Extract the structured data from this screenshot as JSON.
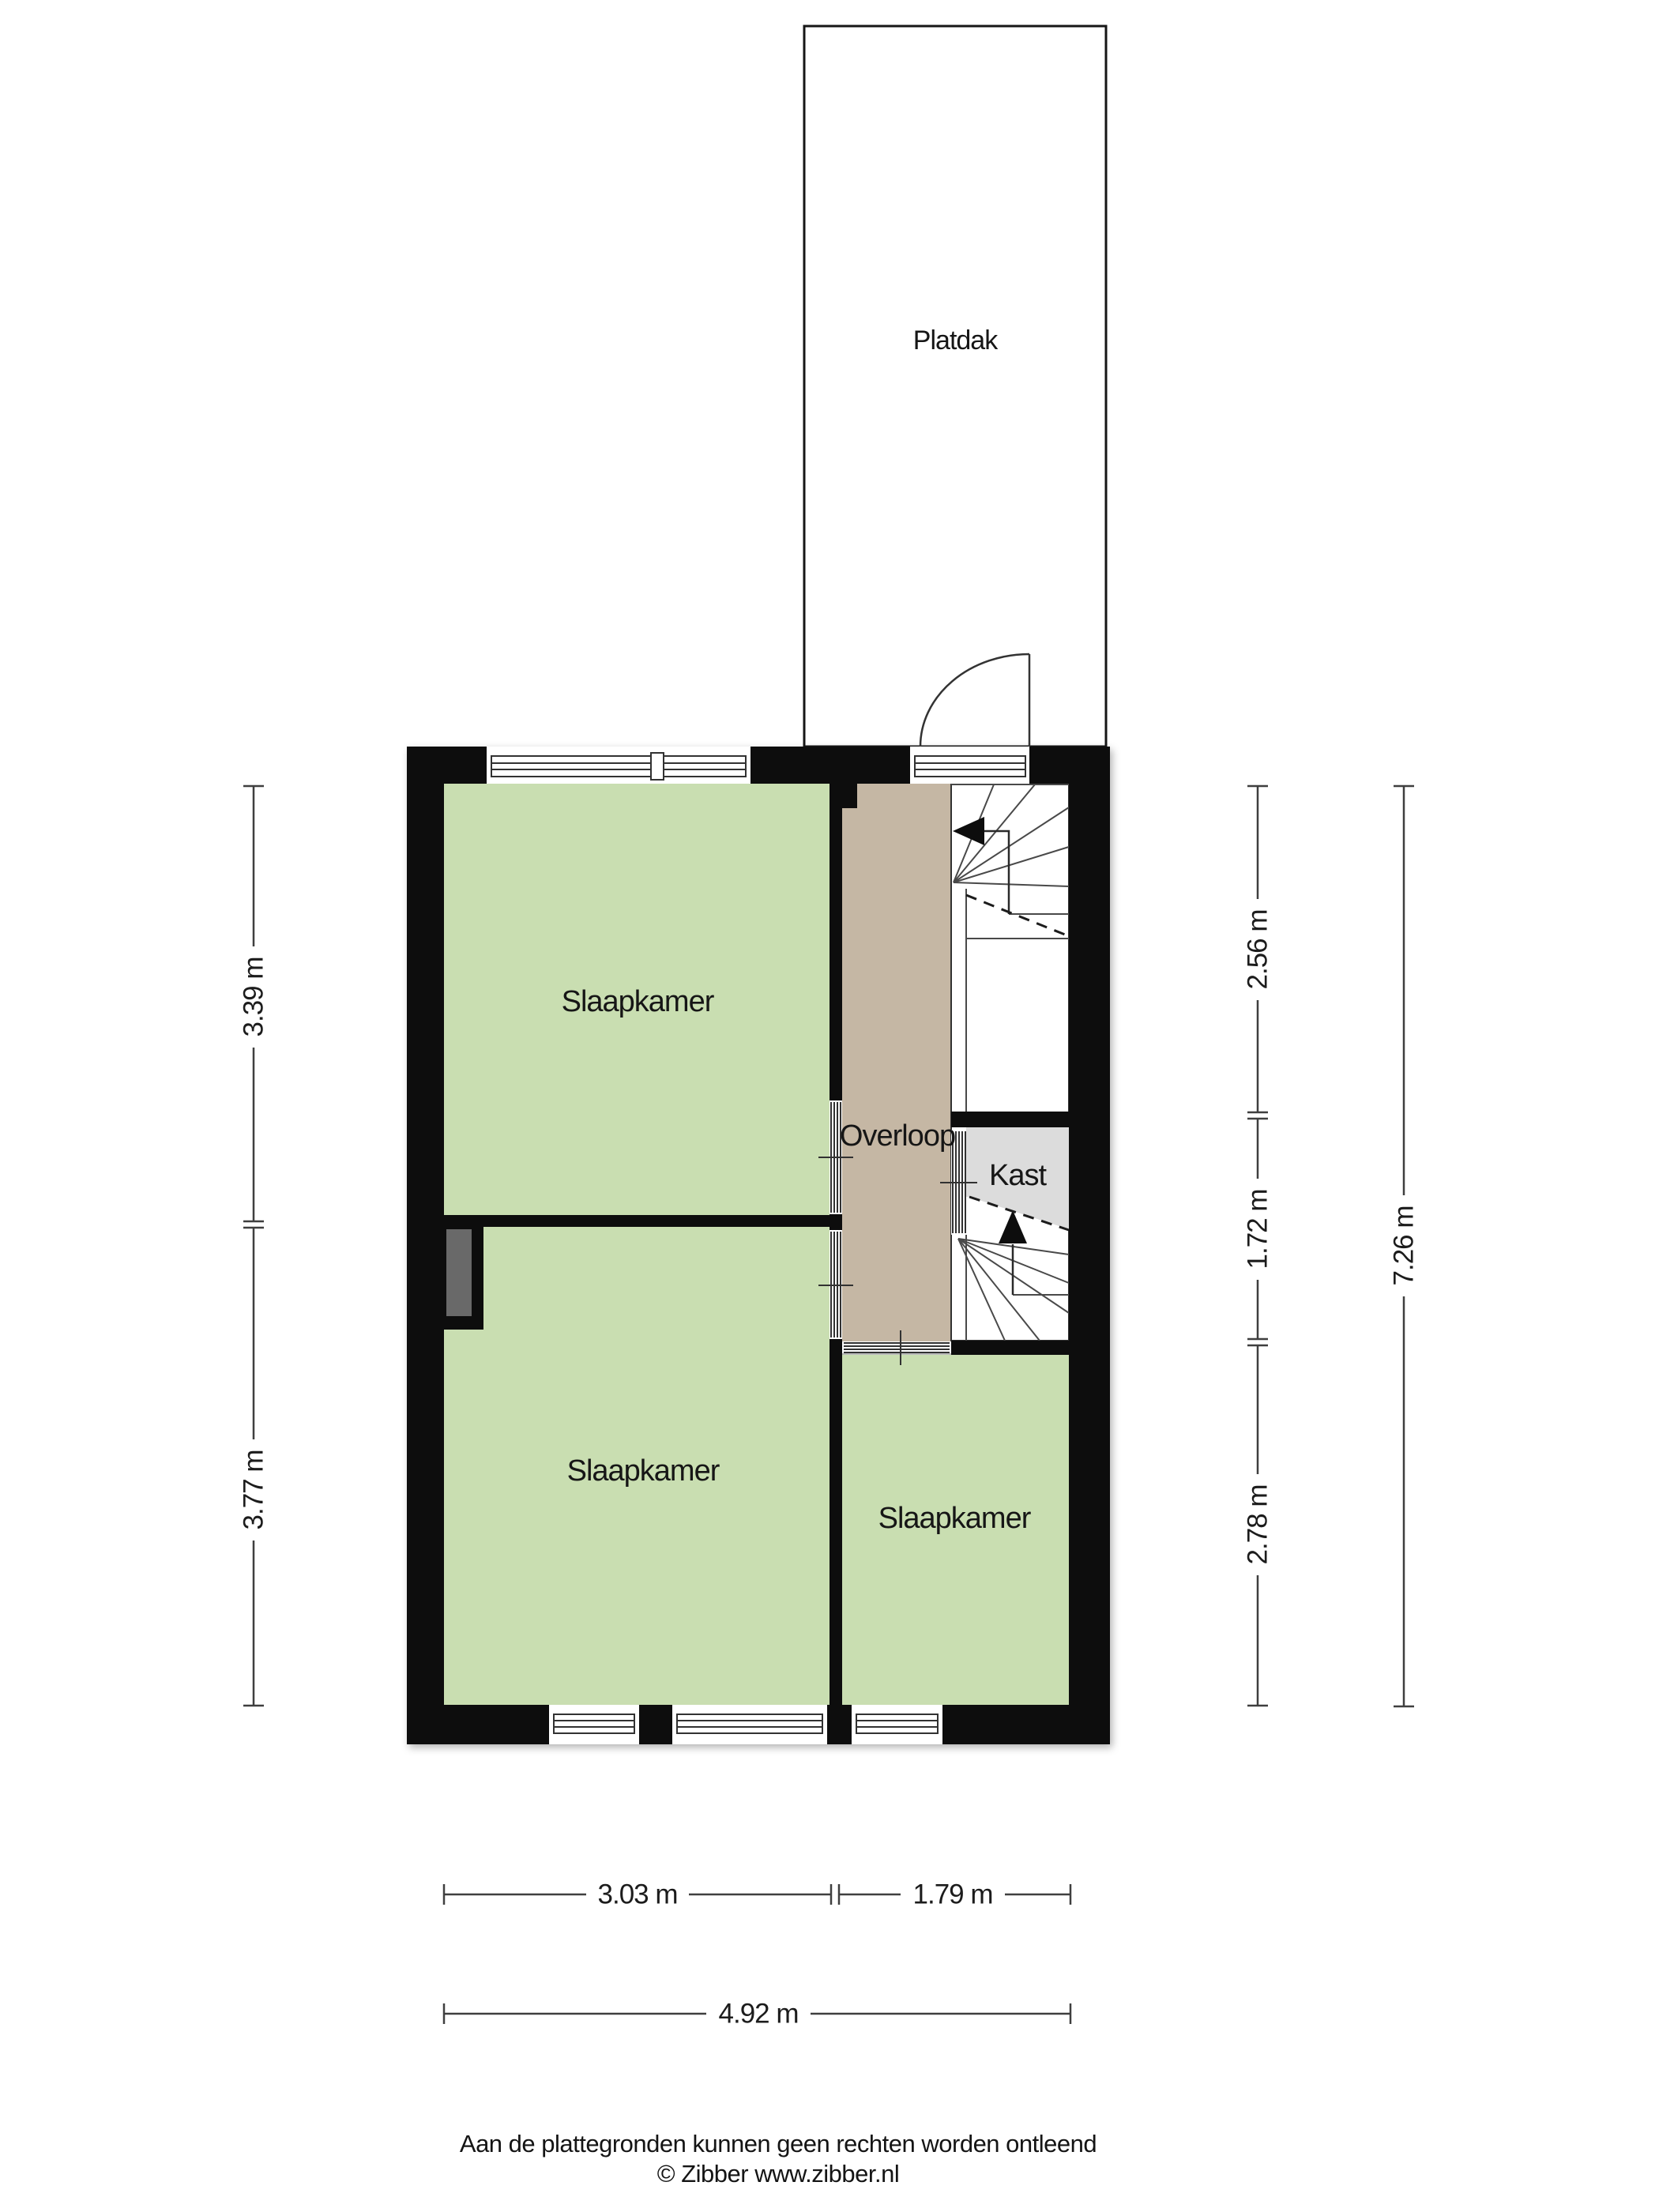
{
  "colors": {
    "wall": "#0d0d0d",
    "bedroom_fill": "#c9deb1",
    "landing_fill": "#c5b7a4",
    "closet_fill": "#dcdcdc",
    "duct_fill": "#696969",
    "stair_line": "#4a4a4a",
    "dimension_line": "#3f3f3f"
  },
  "plan": {
    "flat_roof_label": "Platdak",
    "rooms": [
      {
        "id": "bedroom-top-left",
        "label": "Slaapkamer"
      },
      {
        "id": "bedroom-bottom-left",
        "label": "Slaapkamer"
      },
      {
        "id": "bedroom-bottom-right",
        "label": "Slaapkamer"
      },
      {
        "id": "landing",
        "label": "Overloop"
      },
      {
        "id": "closet",
        "label": "Kast"
      }
    ]
  },
  "dimensions": {
    "left": [
      {
        "label": "3.39 m"
      },
      {
        "label": "3.77 m"
      }
    ],
    "right_inner": [
      {
        "label": "2.56 m"
      },
      {
        "label": "1.72 m"
      },
      {
        "label": "2.78 m"
      }
    ],
    "right_total": {
      "label": "7.26 m"
    },
    "bottom": [
      {
        "label": "3.03 m"
      },
      {
        "label": "1.79 m"
      }
    ],
    "bottom_total": {
      "label": "4.92 m"
    }
  },
  "footer": {
    "disclaimer": "Aan de plattegronden kunnen geen rechten worden ontleend",
    "credit": "© Zibber www.zibber.nl"
  }
}
